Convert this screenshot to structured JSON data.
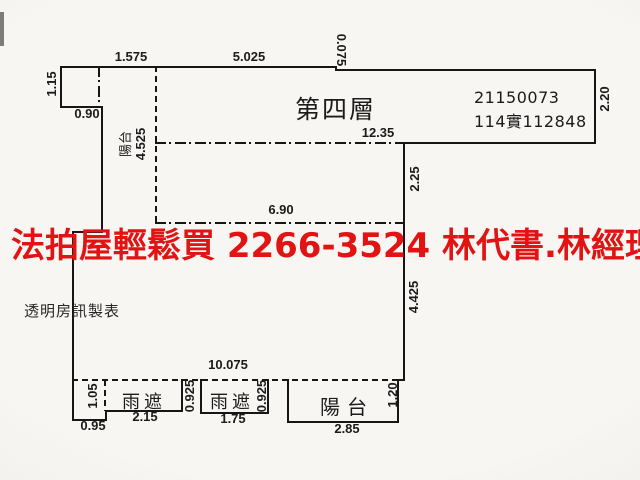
{
  "colors": {
    "paper": "#f4f3f0",
    "ink": "#161616",
    "watermark_red": "#e11313"
  },
  "watermark": {
    "text": "法拍屋輕鬆買 2266-3524 林代書.林經理"
  },
  "labels": {
    "floor": "第四層",
    "case_number": "21150073",
    "lot_number": "114實112848",
    "credit": "透明房訊製表",
    "left_balcony": "陽台",
    "canopy1": "雨遮",
    "canopy2": "雨遮",
    "balcony": "陽台"
  },
  "dimensions": {
    "top_offset": "1.575",
    "top_width": "5.025",
    "top_step": "0.075",
    "box_height": "1.15",
    "box_width": "0.90",
    "band_width": "12.35",
    "band_height": "2.20",
    "upper_right_height": "2.25",
    "mid_width": "6.90",
    "left_balcony_depth": "4.525",
    "lower_right_height": "4.425",
    "bottom_width": "10.075",
    "corner_depth": "1.05",
    "corner_width": "0.95",
    "canopy1_width": "2.15",
    "canopy1_depth": "0.925",
    "canopy2_width": "1.75",
    "canopy2_depth": "0.925",
    "balcony_width": "2.85",
    "balcony_depth": "1.20"
  }
}
